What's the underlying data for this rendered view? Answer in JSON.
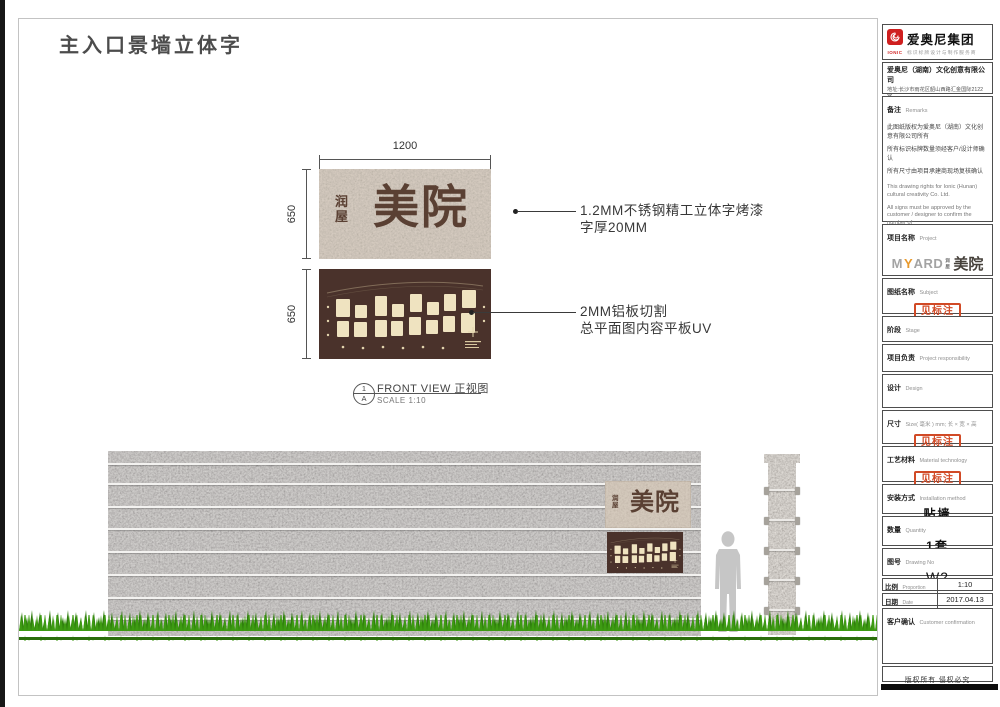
{
  "sheet": {
    "title": "主入口景墙立体字",
    "copyright": "版权所有  侵权必究"
  },
  "drawing": {
    "dim_width": "1200",
    "dim_height_top": "650",
    "dim_height_bottom": "650",
    "sign_small_text": "润屋",
    "sign_large_text": "美院",
    "note1_line1": "1.2MM不锈钢精工立体字烤漆",
    "note1_line2": "字厚20MM",
    "note2_line1": "2MM铝板切割",
    "note2_line2": "总平面图内容平板UV",
    "view_num": "1",
    "view_letter": "A",
    "view_title": "FRONT VIEW 正视图",
    "view_scale": "SCALE 1:10"
  },
  "titleblock": {
    "logo": {
      "icon": "ionic-spiral-icon",
      "brand": "IONIC",
      "group": "爱奥尼集团",
      "tagline": "标识标牌设计与制作服务商"
    },
    "company": {
      "name": "爱奥尼（湖南）文化创意有限公司",
      "address": "地址:长沙市雨花区韶山西路汇金国际2122室",
      "phone": "电话:0731-85074045",
      "website": "http://www.ionic.net.cn"
    },
    "remarks": {
      "label_zh": "备注",
      "label_en": "Remarks",
      "zh1": "此图纸版权为爱奥尼（湖南）文化创意有限公司所有",
      "zh2": "所有标识标牌数量须经客户/设计师确认",
      "zh3": "所有尺寸由项目承建商现场复核确认",
      "en1": "This drawing rights for Ionic (Hunan) cultural creativity Co. Ltd.",
      "en2": "All signs must be approved by the customer / designer to confirm the number of",
      "en3": "All dimensions by the project contractors on-site review confirmed"
    },
    "project": {
      "label_zh": "项目名称",
      "label_en": "Project",
      "logo_pre": "M",
      "logo_accent": "Y",
      "logo_post": "ARD",
      "logo_small": "润屋",
      "logo_brand": "美院"
    },
    "subject": {
      "label_zh": "图纸名称",
      "label_en": "Subject",
      "stamp": "见标注"
    },
    "stage": {
      "label_zh": "阶段",
      "label_en": "Stage"
    },
    "responsibility": {
      "label_zh": "项目负责",
      "label_en": "Project responsibility"
    },
    "design": {
      "label_zh": "设计",
      "label_en": "Design"
    },
    "size": {
      "label_zh": "尺寸",
      "label_en": "Size( 毫米 ) mm; 长 × 宽 × 高",
      "stamp": "见标注"
    },
    "material": {
      "label_zh": "工艺材料",
      "label_en": "Material technology",
      "stamp": "见标注"
    },
    "installation": {
      "label_zh": "安装方式",
      "label_en": "Installation method",
      "value": "贴墙"
    },
    "quantity": {
      "label_zh": "数量",
      "label_en": "Quantity",
      "value": "1套"
    },
    "drawing_no": {
      "label_zh": "图号",
      "label_en": "Drawing No",
      "value": "W2"
    },
    "proportion": {
      "label_zh": "比例",
      "label_en": "Proportion",
      "value": "1:10"
    },
    "date": {
      "label_zh": "日期",
      "label_en": "Date",
      "value": "2017.04.13"
    },
    "confirmation": {
      "label_zh": "客户确认",
      "label_en": "Customer confirmation"
    }
  },
  "colors": {
    "accent_red": "#cf1f1f",
    "stamp_red": "#d14a26",
    "letter_brown": "#5a4033",
    "plan_bg": "#4a322b",
    "grass_green": "#3d9b12",
    "logo_orange": "#e8992c"
  }
}
